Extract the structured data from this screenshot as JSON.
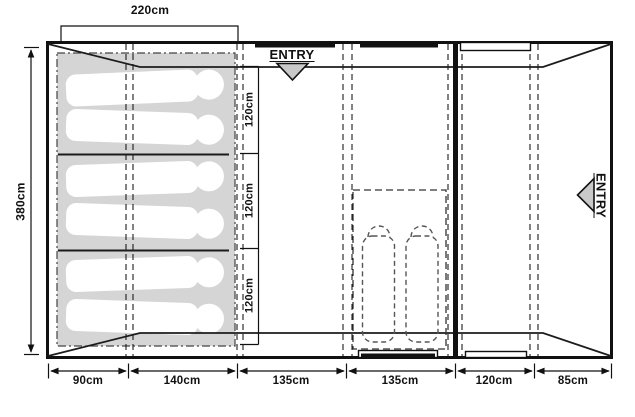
{
  "diagram": {
    "type": "tent-floorplan",
    "overall": {
      "width_label": "220cm",
      "depth_label": "380cm"
    },
    "entries": {
      "top": "ENTRY",
      "right": "ENTRY"
    },
    "berths": [
      {
        "label": "120cm"
      },
      {
        "label": "120cm"
      },
      {
        "label": "120cm"
      }
    ],
    "bottom_sections": [
      {
        "label": "90cm"
      },
      {
        "label": "140cm"
      },
      {
        "label": "135cm"
      },
      {
        "label": "135cm"
      },
      {
        "label": "120cm"
      },
      {
        "label": "85cm"
      }
    ],
    "icons": {
      "entry_top": "triangle-down",
      "entry_right": "triangle-left"
    },
    "colors": {
      "line": "#111111",
      "sleep_area_fill": "#d5d5d5",
      "arrow_fill": "#c9c9c9",
      "silhouette_fill": "#ffffff"
    }
  }
}
